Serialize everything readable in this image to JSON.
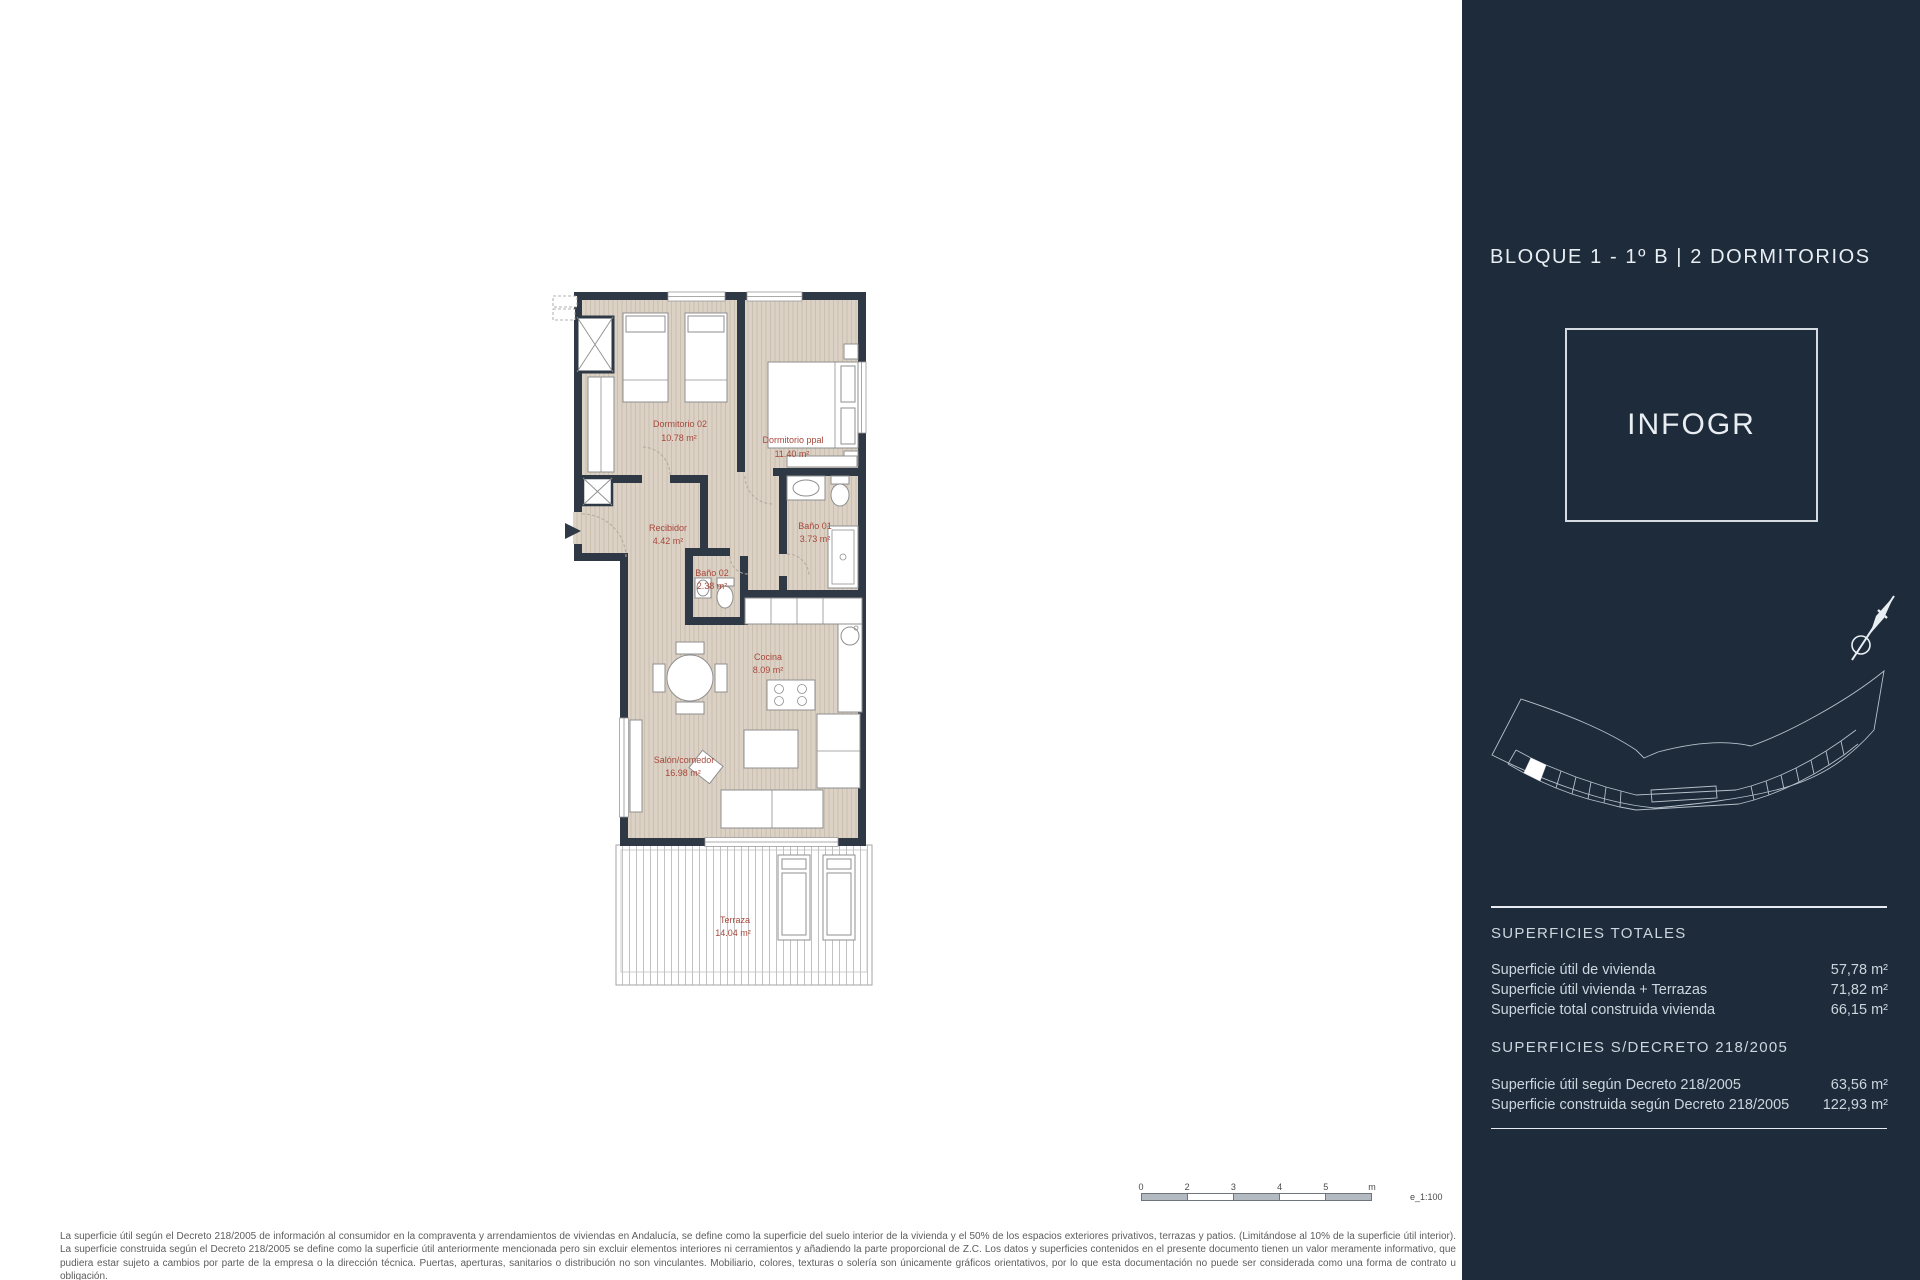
{
  "colors": {
    "sidebar_bg": "#1d2b3b",
    "wall": "#2f3845",
    "floor": "#dbd1c5",
    "floor_stripe": "#cbbfb0",
    "label_red": "#a8473a",
    "sidebar_text": "#ccd6dd",
    "sidebar_text_bright": "#e9eef3",
    "furniture_stroke": "#8f8f8f",
    "deck_line": "#bcbcbc",
    "disclaimer_text": "#5d5d5d",
    "line_gray": "#6f757d"
  },
  "floor_plan": {
    "rooms": [
      {
        "name": "Dormitorio 02",
        "area": "10.78 m²"
      },
      {
        "name": "Dormitorio ppal",
        "area": "11.40 m²"
      },
      {
        "name": "Recibidor",
        "area": "4.42 m²"
      },
      {
        "name": "Baño 01",
        "area": "3.73 m²"
      },
      {
        "name": "Baño 02",
        "area": "2.38 m²"
      },
      {
        "name": "Cocina",
        "area": "8.09 m²"
      },
      {
        "name": "Salón/comedor",
        "area": "16.98 m²"
      },
      {
        "name": "Terraza",
        "area": "14.04 m²"
      }
    ]
  },
  "scale_bar": {
    "ticks": [
      "0",
      "2",
      "3",
      "4",
      "5",
      "m"
    ],
    "scale_note": "e_1:100"
  },
  "disclaimer": "La superficie útil según el Decreto 218/2005 de información al consumidor en la compraventa y arrendamientos de viviendas en Andalucía, se define como la superficie del suelo interior de la vivienda y el 50% de los espacios exteriores privativos, terrazas y patios. (Limitándose al 10% de la superficie útil interior). La superficie construida según el Decreto 218/2005 se define como la superficie útil anteriormente mencionada pero sin excluir elementos interiores ni cerramientos y añadiendo la parte proporcional de Z.C. Los datos y superficies contenidos en el presente documento tienen un valor meramente informativo, que pudiera estar sujeto a cambios por parte de la empresa o la dirección técnica. Puertas, aperturas, sanitarios o distribución no son vinculantes. Mobiliario, colores, texturas o solería son únicamente gráficos orientativos, por lo que esta documentación no puede ser considerada como una forma de contrato u obligación.",
  "sidebar": {
    "title": "BLOQUE 1 - 1º B | 2 DORMITORIOS",
    "logo_text": "INFOGR",
    "sections": [
      {
        "header": "SUPERFICIES TOTALES",
        "rows": [
          {
            "label": "Superficie útil de vivienda",
            "value": "57,78 m²"
          },
          {
            "label": "Superficie útil vivienda + Terrazas",
            "value": "71,82 m²"
          },
          {
            "label": "Superficie total construida vivienda",
            "value": "66,15 m²"
          }
        ]
      },
      {
        "header": "SUPERFICIES S/DECRETO 218/2005",
        "rows": [
          {
            "label": "Superficie útil según Decreto 218/2005",
            "value": "63,56 m²"
          },
          {
            "label": "Superficie construida según Decreto 218/2005",
            "value": "122,93 m²"
          }
        ]
      }
    ]
  }
}
